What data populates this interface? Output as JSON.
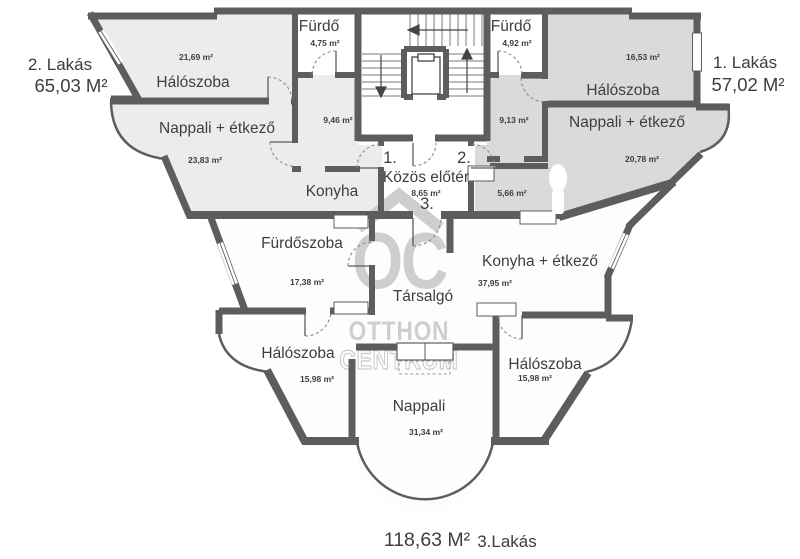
{
  "apartments": {
    "apt1": {
      "label": "1. Lakás",
      "area": "57,02 M²"
    },
    "apt2": {
      "label": "2. Lakás",
      "area": "65,03 M²"
    },
    "apt3": {
      "label": "3.Lakás",
      "area": "118,63 M²"
    }
  },
  "rooms": {
    "bedroom_tl": {
      "name": "Hálószoba",
      "area": "21,69 m²"
    },
    "bath_l": {
      "name": "Fürdő",
      "area": "4,75 m²"
    },
    "hall_l": {
      "area": "9,46 m²"
    },
    "living_l": {
      "name": "Nappali + étkező",
      "area": "23,83 m²"
    },
    "kitchen_l": {
      "name": "Konyha"
    },
    "bath_r": {
      "name": "Fürdő",
      "area": "4,92 m²"
    },
    "bedroom_tr": {
      "name": "Hálószoba",
      "area": "16,53 m²"
    },
    "hall_r": {
      "area": "9,13 m²"
    },
    "living_r": {
      "name": "Nappali + étkező",
      "area": "20,78 m²"
    },
    "foyer": {
      "name": "Közös előtér",
      "area": "8,65 m²"
    },
    "storage": {
      "area": "5,66 m²"
    },
    "bathroom_b": {
      "name": "Fürdőszoba",
      "area": "17,38 m²"
    },
    "lounge": {
      "name": "Társalgó"
    },
    "kitchen_b": {
      "name": "Konyha + étkező",
      "area": "37,95 m²"
    },
    "bedroom_bl": {
      "name": "Hálószoba",
      "area": "15,98 m²"
    },
    "bedroom_br": {
      "name": "Hálószoba",
      "area": "15,98 m²"
    },
    "living_b": {
      "name": "Nappali",
      "area": "31,34 m²"
    }
  },
  "doors": {
    "d1": "1.",
    "d2": "2.",
    "d3": "3."
  },
  "watermark": {
    "monogram": "OC",
    "line1": "OTTHON",
    "line2": "CENTRUM"
  },
  "colors": {
    "wall": "#5d5d5d",
    "apartment1_fill": "#dadada",
    "apartment2_fill": "#ececec",
    "apartment3_fill": "#fdfdfd",
    "label_text": "#3e3e3e",
    "watermark": "#c9c9c9"
  }
}
